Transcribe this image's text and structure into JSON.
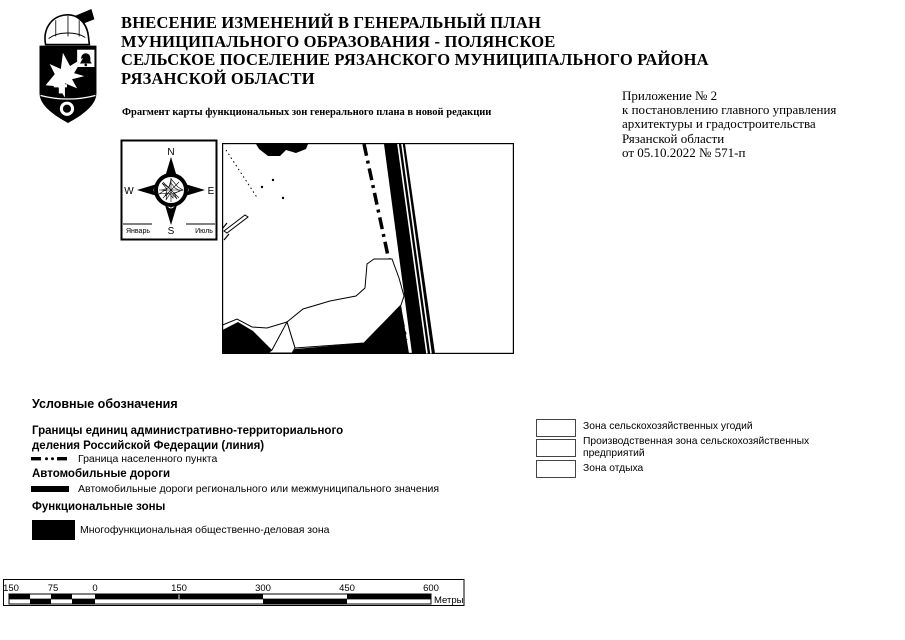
{
  "colors": {
    "ink": "#000000",
    "paper": "#ffffff"
  },
  "header": {
    "title_lines": [
      "ВНЕСЕНИЕ ИЗМЕНЕНИЙ В ГЕНЕРАЛЬНЫЙ ПЛАН",
      "МУНИЦИПАЛЬНОГО ОБРАЗОВАНИЯ - ПОЛЯНСКОЕ",
      "СЕЛЬСКОЕ ПОСЕЛЕНИЕ РЯЗАНСКОГО МУНИЦИПАЛЬНОГО РАЙОНА",
      "РЯЗАНСКОЙ ОБЛАСТИ"
    ],
    "subtitle": "Фрагмент карты функциональных зон генерального плана в новой редакции",
    "appendix_lines": [
      "Приложение № 2",
      "к постановлению главного управления",
      "архитектуры и градостроительства",
      "Рязанской области",
      "от 05.10.2022 № 571-п"
    ]
  },
  "compass": {
    "n": "N",
    "s": "S",
    "w": "W",
    "e": "E",
    "january": "Январь",
    "july": "Июль"
  },
  "legend": {
    "heading": "Условные обозначения",
    "admin_boundaries_title_line1": "Границы единиц административно-территориального",
    "admin_boundaries_title_line2": "деления Российской Федерации (линия)",
    "settlement_boundary_label": "Граница населенного пункта",
    "roads_title": "Автомобильные дороги",
    "roads_label": "Автомобильные дороги регионального или межмуниципального значения",
    "zones_title": "Функциональные зоны",
    "zones_label": "Многофункциональная общественно-деловая зона",
    "agricultural_zone_label": "Зона сельскохозяйственных угодий",
    "industrial_agro_zone_label": "Производственная зона сельскохозяйственных предприятий",
    "recreation_zone_label": "Зона отдыха"
  },
  "scalebar": {
    "labels": [
      "150",
      "75",
      "0",
      "150",
      "300",
      "450",
      "600"
    ],
    "units": "Метры"
  }
}
